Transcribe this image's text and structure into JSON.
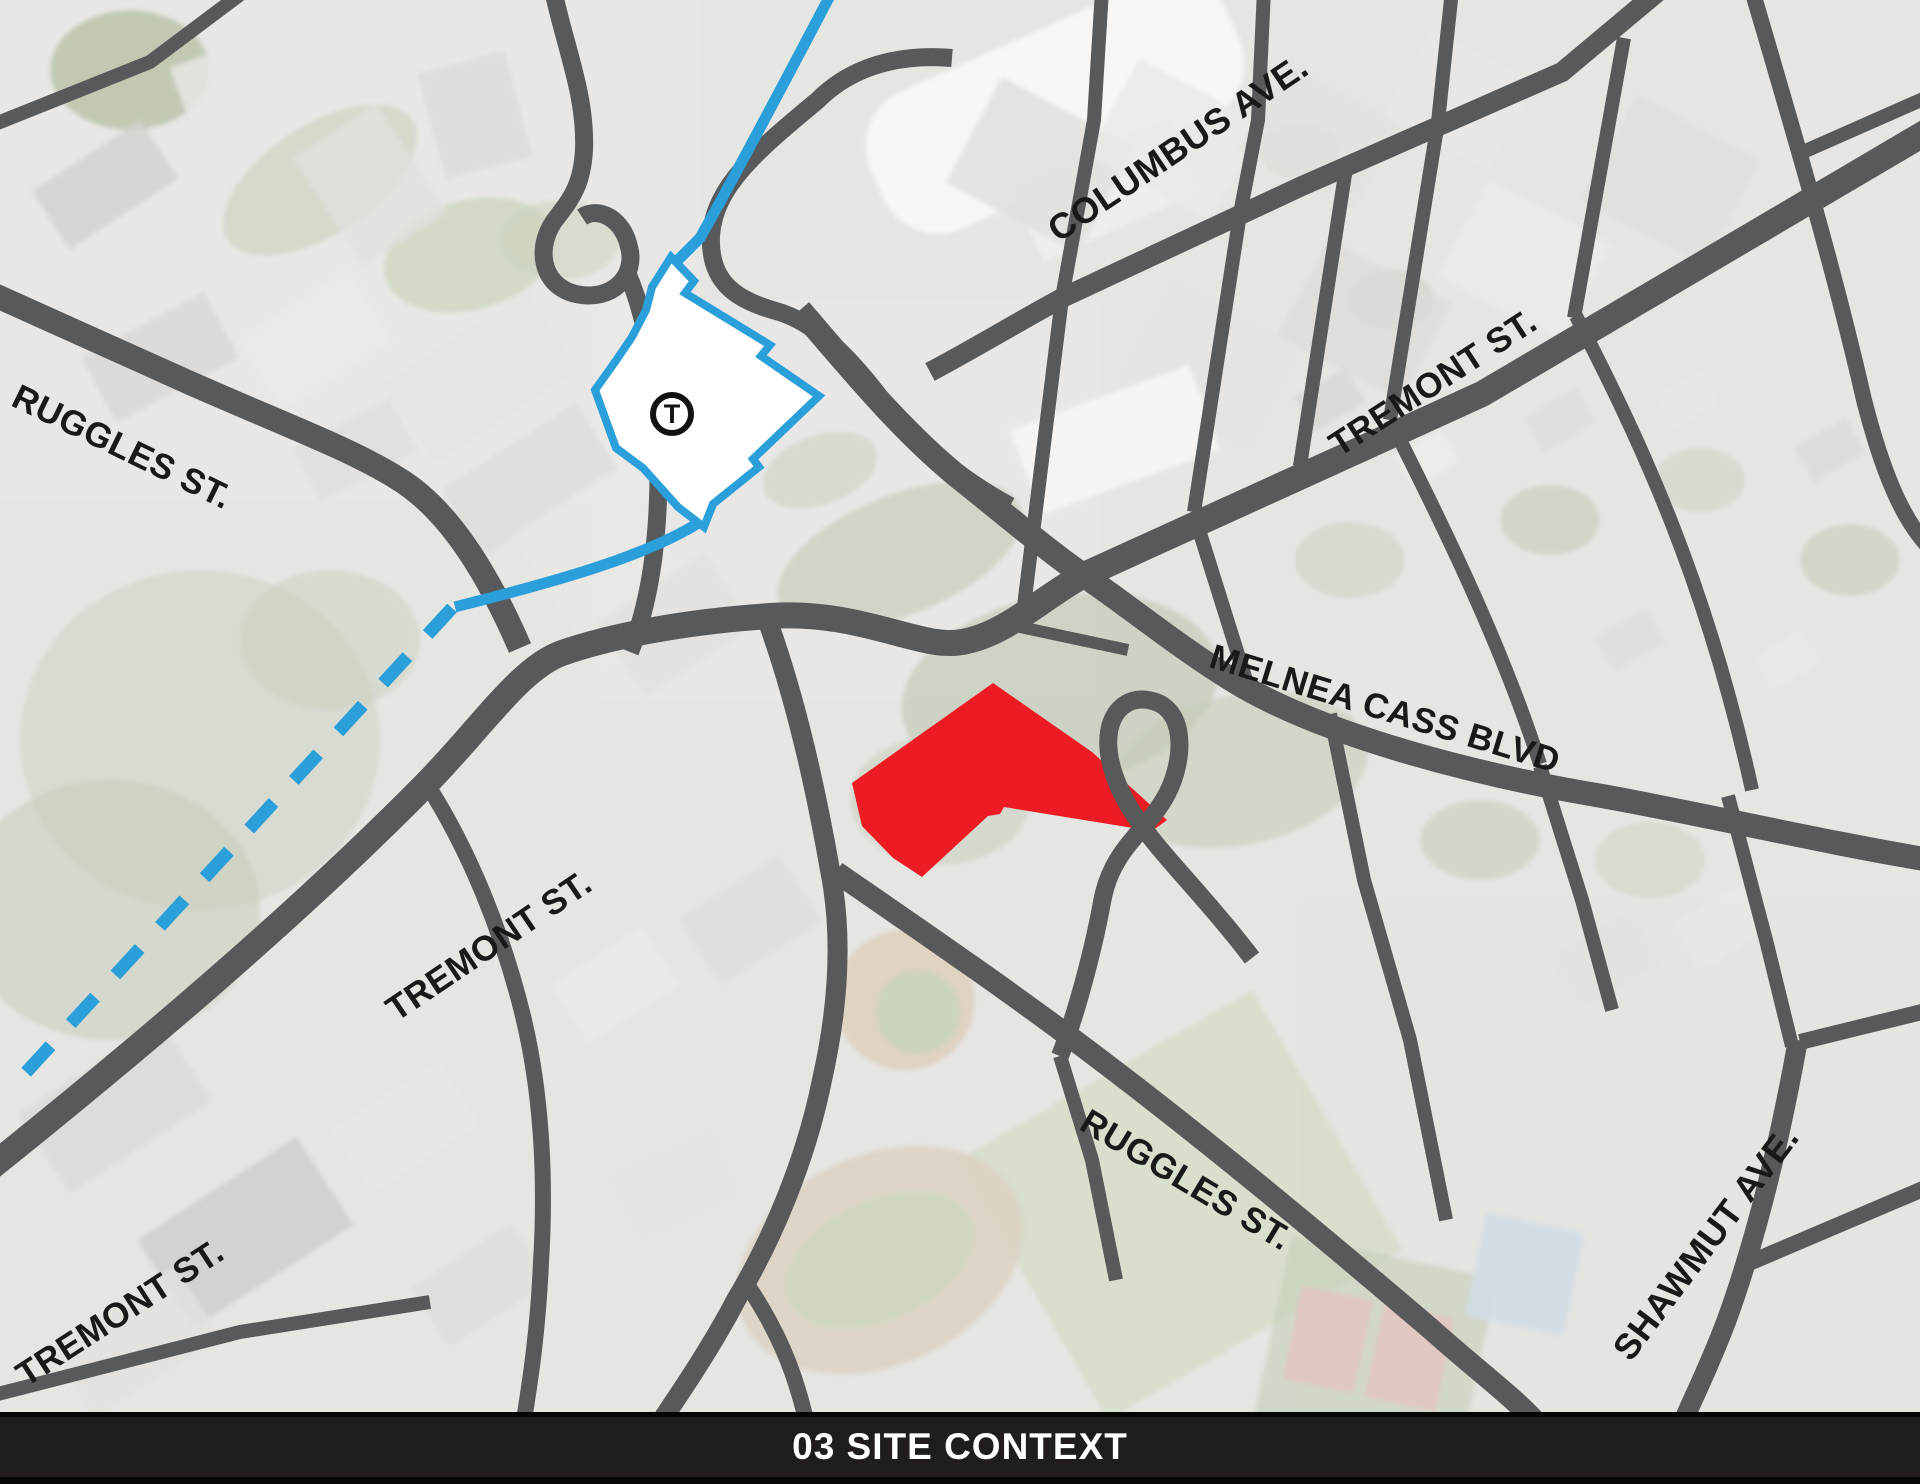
{
  "map": {
    "street_labels": [
      {
        "id": "ruggles-st-nw",
        "text": "RUGGLES ST."
      },
      {
        "id": "columbus-ave",
        "text": "COLUMBUS AVE."
      },
      {
        "id": "tremont-st-ne",
        "text": "TREMONT ST."
      },
      {
        "id": "melnea-cass-blvd",
        "text": "MELNEA CASS BLVD"
      },
      {
        "id": "tremont-st-center",
        "text": "TREMONT ST."
      },
      {
        "id": "tremont-st-sw",
        "text": "TREMONT ST."
      },
      {
        "id": "ruggles-st-s",
        "text": "RUGGLES ST."
      },
      {
        "id": "shawmut-ave",
        "text": "SHAWMUT AVE."
      }
    ],
    "station_marker": {
      "symbol": "T"
    },
    "colors": {
      "site_parcel": "#EC1B24",
      "transit_line": "#2A9FD9",
      "road": "#58595B",
      "station_fill": "#FFFFFF"
    }
  },
  "footer": {
    "title": "03 SITE CONTEXT"
  }
}
